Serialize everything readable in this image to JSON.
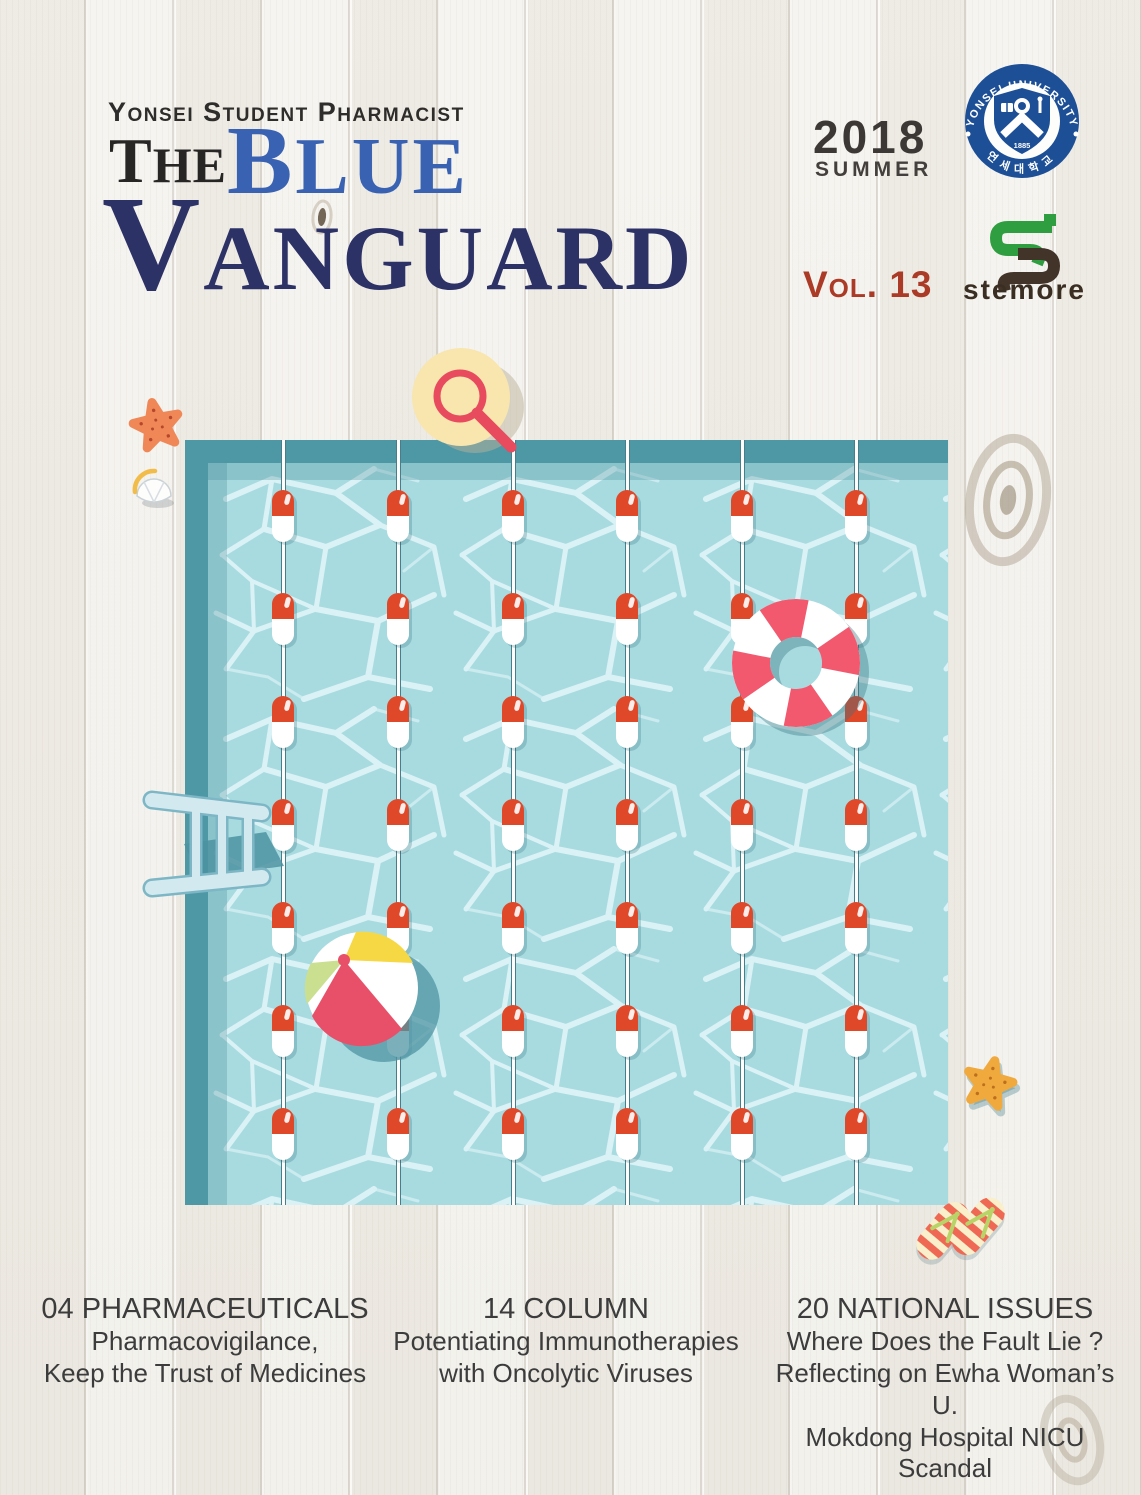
{
  "masthead": {
    "kicker": "Yonsei Student Pharmacist",
    "title": {
      "word1": {
        "cap": "T",
        "rest": "HE"
      },
      "word2": {
        "cap": "B",
        "rest": "LUE"
      },
      "word3": {
        "cap": "V",
        "rest": "ANGUARD"
      }
    }
  },
  "issue": {
    "year": "2018",
    "season": "SUMMER",
    "volume": "Vol. 13"
  },
  "seal": {
    "arc_top": "YONSEI UNIVERSITY",
    "arc_bottom": "연세대학교",
    "year": "1885"
  },
  "stemore": {
    "wordmark": "stemore"
  },
  "articles": [
    {
      "heading": "04 PHARMACEUTICALS",
      "lines": [
        "Pharmacovigilance,",
        "Keep the Trust of Medicines"
      ]
    },
    {
      "heading": "14 COLUMN",
      "lines": [
        "Potentiating Immunotherapies",
        "with Oncolytic Viruses"
      ]
    },
    {
      "heading": "20 NATIONAL ISSUES",
      "lines": [
        "Where Does the Fault Lie ?",
        "Reflecting on Ewha Woman’s U.",
        "Mokdong Hospital NICU Scandal"
      ]
    }
  ],
  "pool": {
    "x": 185,
    "y": 440,
    "width": 763,
    "height": 765,
    "deck_color": "#4e98a6",
    "water_color": "#a7dbe0",
    "lanes_x": [
      283,
      398,
      513,
      627,
      742,
      856
    ],
    "float_rows_y": [
      516,
      619,
      722,
      825,
      928,
      1031,
      1134
    ],
    "capsule": {
      "top_color": "#e0482a",
      "bottom_color": "#ffffff"
    }
  },
  "illustration_elements": [
    "magnifier-on-sun-hat",
    "pool",
    "lane-rope-capsule-floats",
    "life-ring",
    "beach-ball",
    "pool-ladder",
    "starfish",
    "seashell",
    "flip-flops"
  ],
  "palette": {
    "title_black": "#272625",
    "title_blue": "#3a62b2",
    "title_navy": "#2c3166",
    "vol_red": "#ab3a27",
    "issue_gray": "#3c3835",
    "article_text": "#3c3c3c",
    "wood_bg": "#f2f0ea",
    "deck_teal": "#4e98a6",
    "water": "#a7dbe0",
    "capsule_red": "#e0482a",
    "ring_pink": "#f2596e",
    "ball_yellow": "#f6d844",
    "ball_green": "#cadf8f",
    "ball_red": "#e8506a",
    "ladder_blue": "#d3e9f0",
    "starfish_orange": "#ef8756",
    "starfish_gold": "#f0a93c",
    "seal_blue": "#1d4f97",
    "stemore_green": "#2f9e41",
    "stemore_brown": "#43342a",
    "magnifier_red": "#e84a5e",
    "hat_yellow": "#f8e6ae"
  }
}
